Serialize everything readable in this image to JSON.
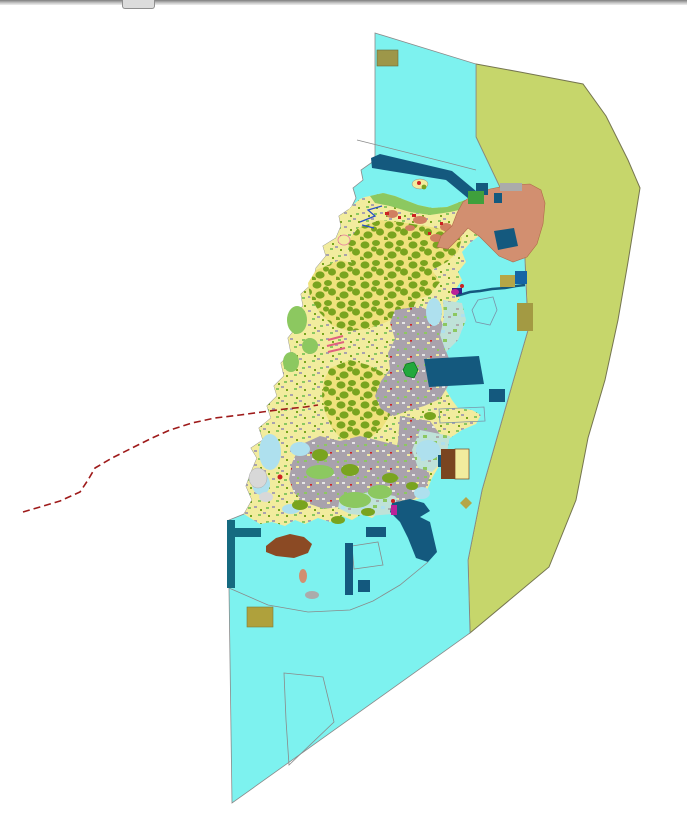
{
  "window": {
    "splitter": {
      "kind": "horizontal-splitter-bar"
    }
  },
  "map": {
    "type": "gis-land-use-map",
    "palette": {
      "sea": "#7df2ef",
      "seaStroke": "#8a8a8a",
      "zone": "#c6d66b",
      "zoneStroke": "#75754f",
      "land": "#f2ec9e",
      "landShade": "#efe27c",
      "forest": "#79a41f",
      "urban": "#a9a2ac",
      "coastGreen": "#8cc860",
      "paleBlue": "#aee0ee",
      "coastMixBg": "#bfe2d8",
      "darkBlue": "#14597e",
      "teal": "#156a80",
      "navy": "#1565a5",
      "salmon": "#d28f70",
      "salmonStroke": "#b06a4a",
      "salmonLight": "#d08060",
      "brown": "#8b4a24",
      "brownDark": "#7a4520",
      "khaki": "#b5a647",
      "khakiDark": "#a39a43",
      "khakiOlive": "#9d9749",
      "khakiSouth": "#afa13c",
      "green": "#3fa03c",
      "brightGreen": "#22a83c",
      "red": "#cc2222",
      "boundaryRed": "#9e1a1a",
      "magenta": "#bb2299",
      "pink": "#e0607e",
      "stream": "#2b50c8",
      "grayBlob": "#ababab",
      "paleGray": "#d8d8d8",
      "speckWhite": "#e6e6e6",
      "outline": "#7a93a8",
      "purple": "#332288"
    }
  }
}
